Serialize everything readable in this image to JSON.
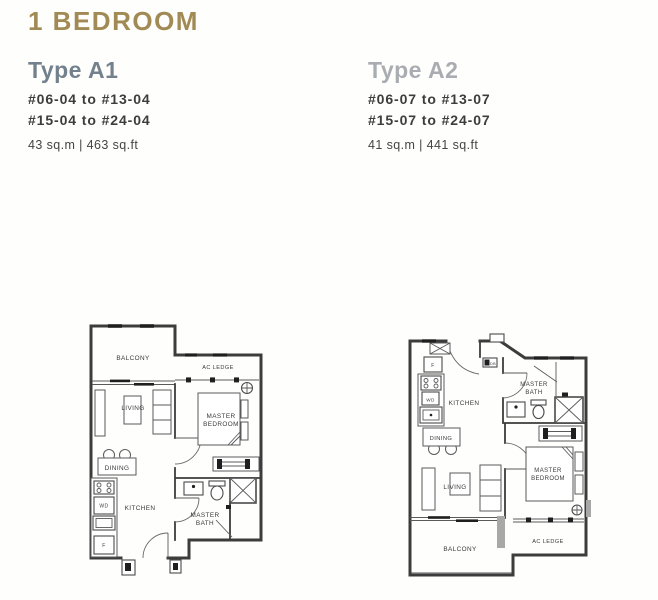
{
  "page": {
    "title": "1 BEDROOM"
  },
  "colors": {
    "title_accent": "#a28a55",
    "type_a1_heading": "#73818d",
    "type_a2_heading": "#a9adb2",
    "unit_text": "#3d3d3d",
    "plan_walls": "#3c3c3c"
  },
  "types": {
    "a1": {
      "name": "Type A1",
      "units_line1": "#06-04 to #13-04",
      "units_line2": "#15-04 to #24-04",
      "area": "43 sq.m | 463 sq.ft"
    },
    "a2": {
      "name": "Type A2",
      "units_line1": "#06-07 to #13-07",
      "units_line2": "#15-07 to #24-07",
      "area": "41 sq.m | 441 sq.ft"
    }
  },
  "plans": {
    "a1": {
      "labels": {
        "balcony": "BALCONY",
        "ac_ledge": "AC LEDGE",
        "living": "LIVING",
        "dining": "DINING",
        "kitchen": "KITCHEN",
        "master_bedroom_1": "MASTER",
        "master_bedroom_2": "BEDROOM",
        "master_bath_1": "MASTER",
        "master_bath_2": "BATH",
        "washer_dryer": "WD",
        "fridge": "F"
      }
    },
    "a2": {
      "labels": {
        "balcony": "BALCONY",
        "ac_ledge": "AC LEDGE",
        "living": "LIVING",
        "dining": "DINING",
        "kitchen": "KITCHEN",
        "master_bedroom_1": "MASTER",
        "master_bedroom_2": "BEDROOM",
        "master_bath_1": "MASTER",
        "master_bath_2": "BATH",
        "washer_dryer": "WD",
        "fridge": "F",
        "db": "DB"
      }
    }
  }
}
